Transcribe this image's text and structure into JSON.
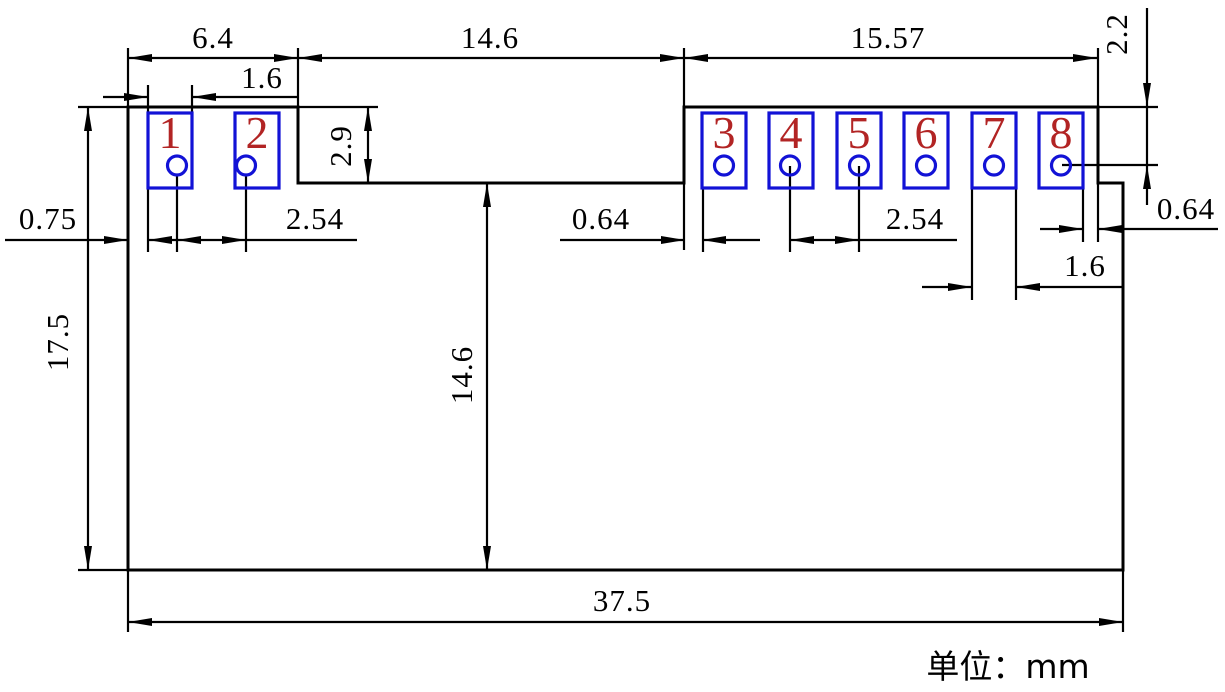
{
  "unit_note": "单位：mm",
  "colors": {
    "outline": "#000000",
    "pad": "#1212d6",
    "pad_number": "#b22424",
    "background": "#ffffff"
  },
  "pads": [
    {
      "number": "1"
    },
    {
      "number": "2"
    },
    {
      "number": "3"
    },
    {
      "number": "4"
    },
    {
      "number": "5"
    },
    {
      "number": "6"
    },
    {
      "number": "7"
    },
    {
      "number": "8"
    }
  ],
  "dims": {
    "left_section_width": "6.4",
    "pad1_width": "1.6",
    "notch_width": "14.6",
    "right_section_width": "15.57",
    "top_to_hole_center": "2.2",
    "edge_to_pad1": "0.75",
    "pad12_hole_pitch": "2.54",
    "notch_to_pad3": "0.64",
    "pad45_hole_pitch": "2.54",
    "pad8_to_edge": "0.64",
    "pad7_width": "1.6",
    "overall_height": "17.5",
    "pad_row_depth": "2.9",
    "notch_to_bottom": "14.6",
    "overall_width": "37.5"
  }
}
